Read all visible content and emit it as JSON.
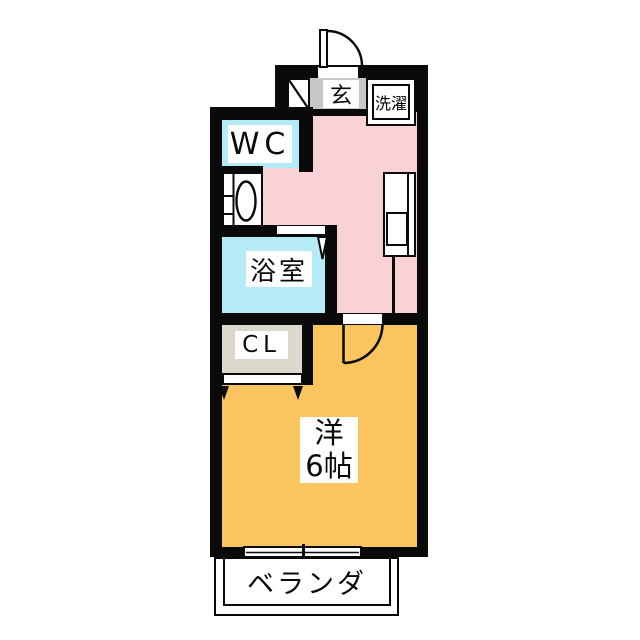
{
  "floorplan": {
    "rooms": {
      "entrance": {
        "label": "玄"
      },
      "laundry": {
        "label": "洗濯"
      },
      "toilet": {
        "label": "WC"
      },
      "bathroom": {
        "label": "浴室"
      },
      "closet": {
        "label": "CL"
      },
      "main_room": {
        "label_line1": "洋",
        "label_line2": "6帖"
      },
      "veranda": {
        "label": "ベランダ"
      }
    },
    "colors": {
      "hall_kitchen_floor": "#f8d2d5",
      "wet_area_floor": "#b5eaf7",
      "main_room_floor": "#fac55e",
      "closet_floor": "#dcd8cb",
      "entrance_floor": "#c7c7c7",
      "wall": "#0a0a0a",
      "fixture_fill": "#ffffff"
    },
    "icons": {
      "entry_door": "door-swing-arc",
      "room_door": "door-swing-arc",
      "bath_door": "folding-door-marker",
      "closet_door": "sliding-panel-arrows",
      "toilet": "toilet-top-view",
      "kitchen_sink": "counter-with-sink",
      "washer": "washing-machine-pan",
      "window": "sliding-window",
      "shoe_cabinet": "diagonal-line-cabinet"
    }
  }
}
